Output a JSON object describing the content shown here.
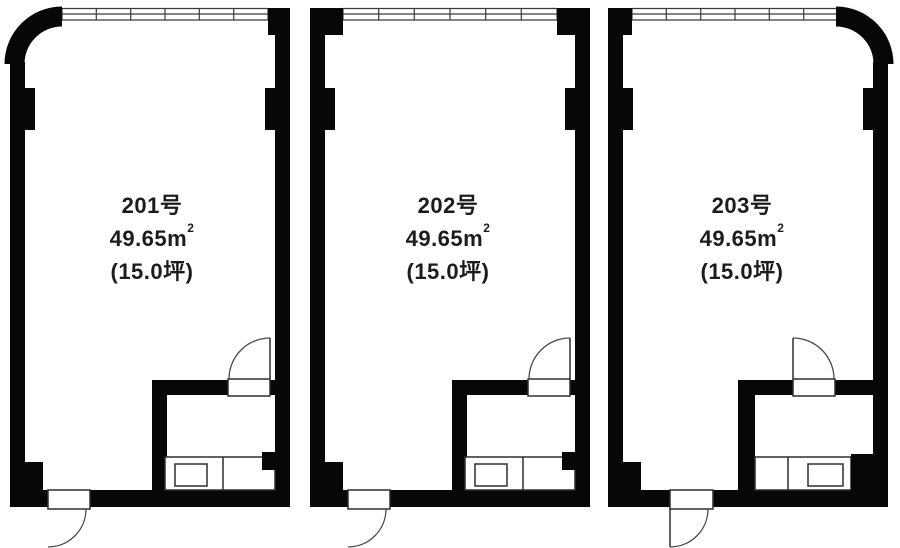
{
  "plan": {
    "type": "floor-plan",
    "building_levels": "2F",
    "units": [
      {
        "room_no": "201号",
        "area": "49.65m",
        "area_exp": "2",
        "tsubo": "(15.0坪)"
      },
      {
        "room_no": "202号",
        "area": "49.65m",
        "area_exp": "2",
        "tsubo": "(15.0坪)"
      },
      {
        "room_no": "203号",
        "area": "49.65m",
        "area_exp": "2",
        "tsubo": "(15.0坪)"
      }
    ],
    "features_per_unit": [
      "window-band-top",
      "entrance-door",
      "bathroom-with-counter-sink"
    ],
    "colors": {
      "wall": "#070707",
      "line": "#2e2e2e",
      "background": "#ffffff"
    }
  }
}
